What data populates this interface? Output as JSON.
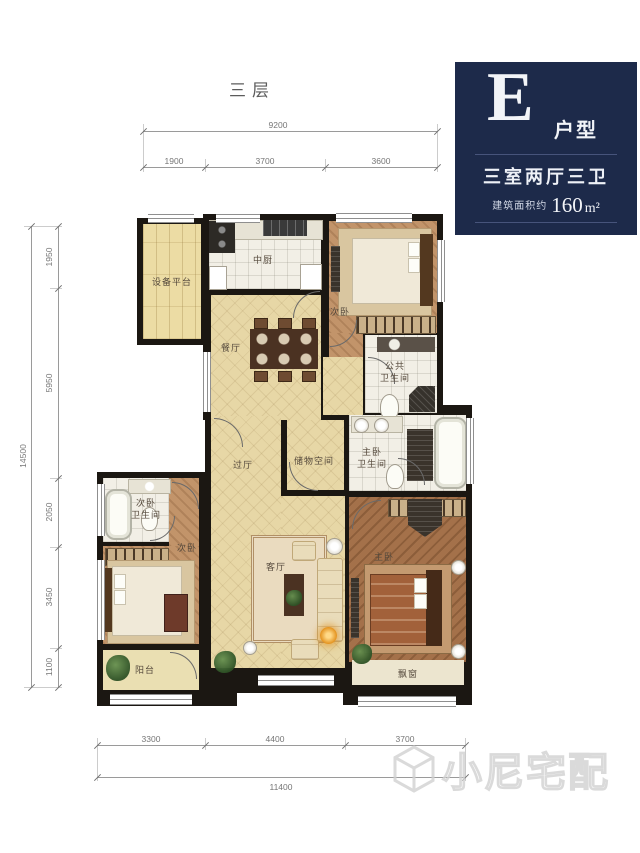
{
  "page": {
    "floor_label": "三层",
    "watermark_text": "小尼宅配"
  },
  "info_box": {
    "type_letter": "E",
    "type_suffix": "户型",
    "layout_text": "三室两厅三卫",
    "area_label": "建筑面积约",
    "area_value": "160",
    "area_unit": "m²"
  },
  "dimensions": {
    "top_total": "9200",
    "top_segments": [
      "1900",
      "3700",
      "3600"
    ],
    "left_total": "14500",
    "left_segments": [
      "1950",
      "5950",
      "2050",
      "3450",
      "1100"
    ],
    "bottom_segments": [
      "3300",
      "4400",
      "3700"
    ],
    "bottom_total": "11400"
  },
  "rooms": {
    "equipment": "设备平台",
    "kitchen": "中厨",
    "bedroom_north": "次卧",
    "dining": "餐厅",
    "public_bath": "公共\n卫生间",
    "hallway": "过厅",
    "storage": "储物空间",
    "master_bath": "主卧\n卫生间",
    "second_bath": "次卧\n卫生间",
    "bedroom_west": "次卧",
    "living": "客厅",
    "master": "主卧",
    "balcony": "阳台",
    "bay_window": "飘窗"
  },
  "colors": {
    "navy": "#1d2a4a",
    "wall": "#1b1712",
    "tile-beige": "#e7d7a6",
    "tile-white": "#f2efe6",
    "wood-light": "#c2946a",
    "wood-dark": "#a4714a",
    "plank": "#ecdca4",
    "dim-line": "#9a9a9a",
    "dim-text": "#767676",
    "label-text": "#55493c",
    "lamp-orange": "#e08a12"
  }
}
